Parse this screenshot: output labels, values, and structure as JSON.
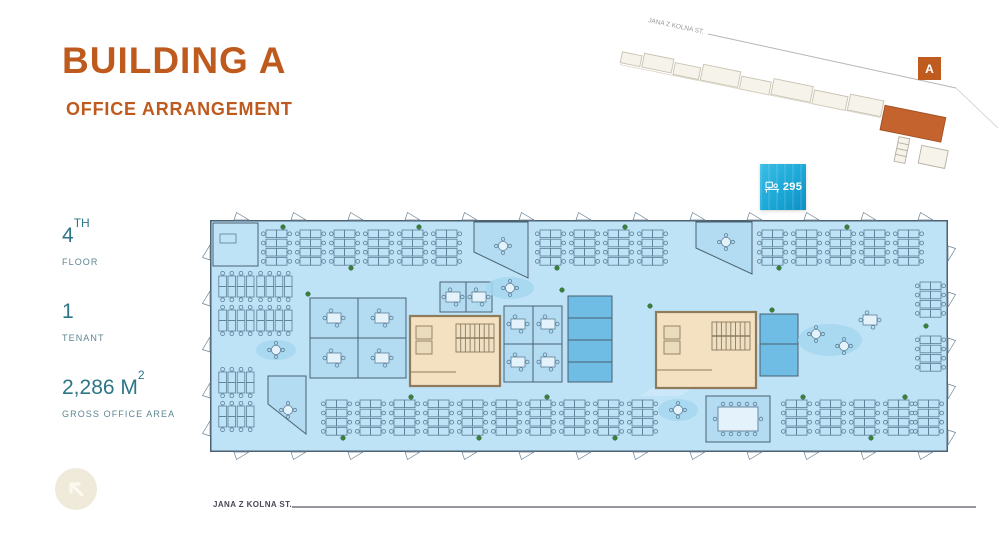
{
  "header": {
    "title": "BUILDING A",
    "subtitle": "OFFICE ARRANGEMENT"
  },
  "stats": [
    {
      "value": "4",
      "value_sup": "TH",
      "label": "FLOOR"
    },
    {
      "value": "1",
      "value_sup": "",
      "label": "TENANT"
    },
    {
      "value": "2,286 M",
      "value_sup": "2",
      "label": "GROSS OFFICE AREA"
    }
  ],
  "badge": {
    "count": "295",
    "icon": "workstation-icon",
    "meaning": "workstations on floor"
  },
  "minimap": {
    "street_label": "JANA Z KOLNA ST.",
    "building_label": "A"
  },
  "street": {
    "label": "JANA Z KOLNA ST."
  },
  "colors": {
    "accent_orange": "#BE5A1D",
    "stat_teal": "#2E7587",
    "badge_cyan": "#1BA7D6",
    "plan_fill": "#BEE2F6",
    "room_blue": "#B3DCF3",
    "service_blue": "#6FBCE4",
    "core_beige": "#F4E1C1",
    "plant_green": "#3C7F3C",
    "minimap_building_orange": "#C4632E"
  }
}
